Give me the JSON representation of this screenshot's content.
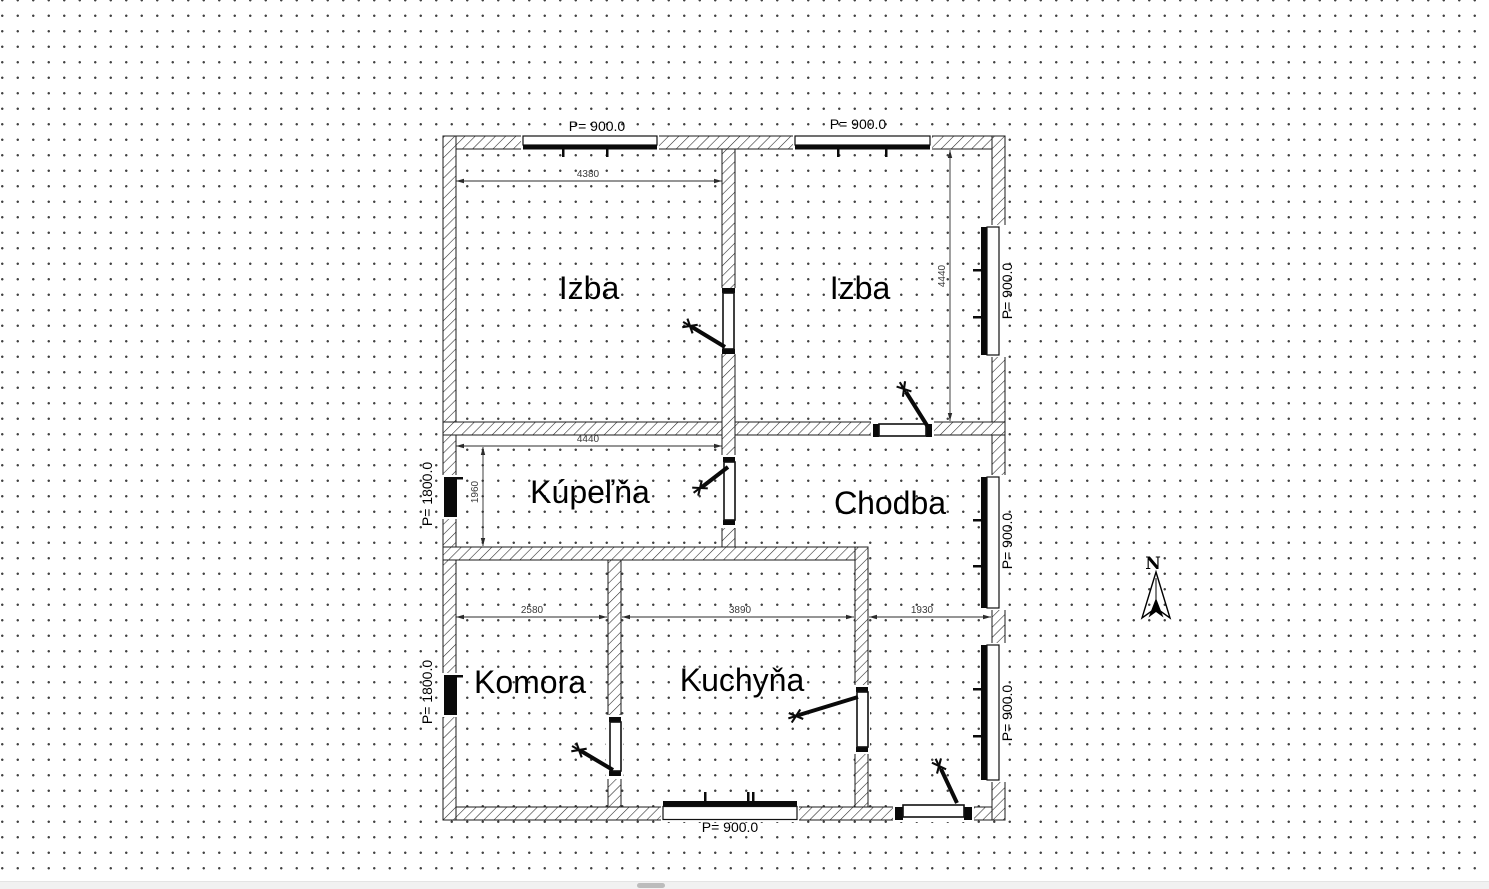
{
  "floor_plan": {
    "rooms": [
      {
        "label": "Izba"
      },
      {
        "label": "Izba"
      },
      {
        "label": "Kúpeľňa"
      },
      {
        "label": "Chodba"
      },
      {
        "label": "Komora"
      },
      {
        "label": "Kuchyňa"
      }
    ],
    "window_labels": {
      "top_left": "P= 900.0",
      "top_right": "P= 900.0",
      "right_upper": "P= 900.0",
      "right_middle": "P= 900.0",
      "right_lower": "P= 900.0",
      "left_upper": "P= 1800.0",
      "left_lower": "P= 1800.0",
      "bottom": "P= 900.0"
    },
    "dimensions": {
      "top_room_width": "4380",
      "right_room_height": "4440",
      "bathroom_width": "4440",
      "bathroom_height": "1960",
      "pantry_width": "2580",
      "kitchen_width": "3890",
      "hall_width": "1930"
    },
    "compass": {
      "north_label": "N"
    }
  },
  "colors": {
    "wall_line": "#1b1b1b",
    "dimension_text": "#3a3a3a",
    "grid_dot": "#414141",
    "scrollbar_track": "#f1f1f1",
    "scrollbar_thumb": "#bcbcbc"
  }
}
